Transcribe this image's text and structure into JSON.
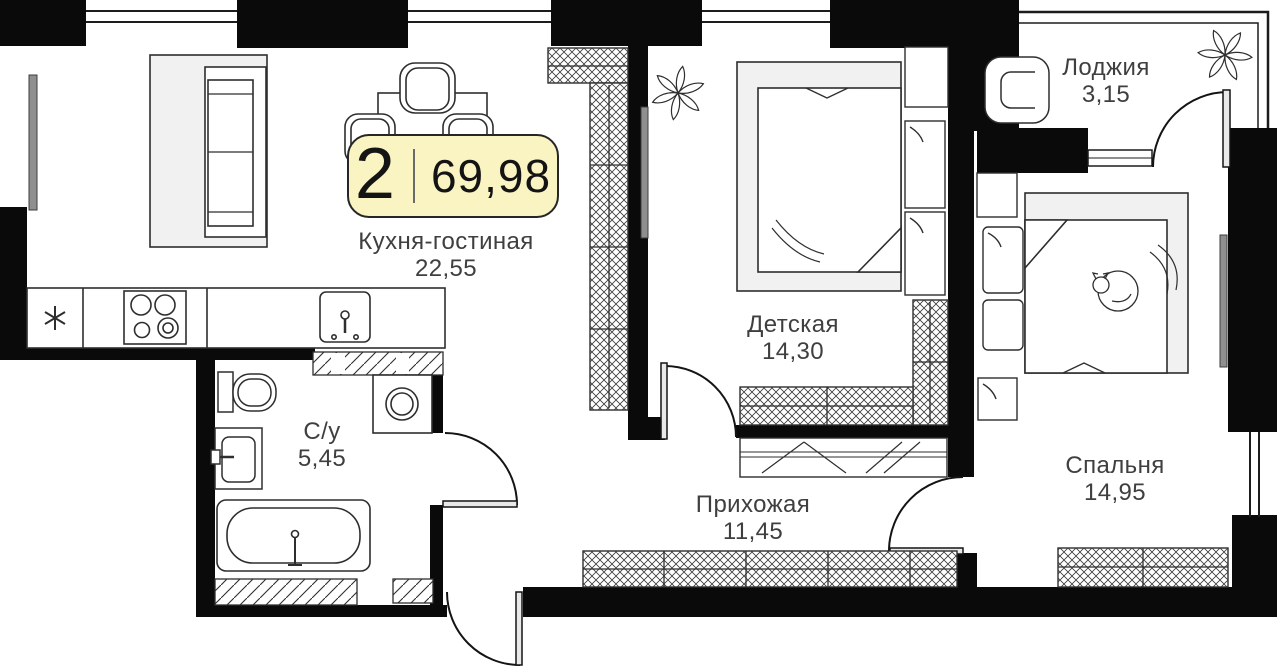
{
  "plan": {
    "badge": {
      "rooms": "2",
      "area": "69,98"
    },
    "rooms": [
      {
        "id": "kitchen_living",
        "name": "Кухня-гостиная",
        "area": "22,55"
      },
      {
        "id": "children",
        "name": "Детская",
        "area": "14,30"
      },
      {
        "id": "loggia",
        "name": "Лоджия",
        "area": "3,15"
      },
      {
        "id": "bathroom",
        "name": "С/у",
        "area": "5,45"
      },
      {
        "id": "hallway",
        "name": "Прихожая",
        "area": "11,45"
      },
      {
        "id": "bedroom",
        "name": "Спальня",
        "area": "14,95"
      }
    ],
    "colors": {
      "badge_fill": "#faf3c2",
      "badge_border": "#262626",
      "wall": "#0a0a0a",
      "text": "#3f3f3f",
      "furniture_fill": "#f1f1f1"
    }
  }
}
